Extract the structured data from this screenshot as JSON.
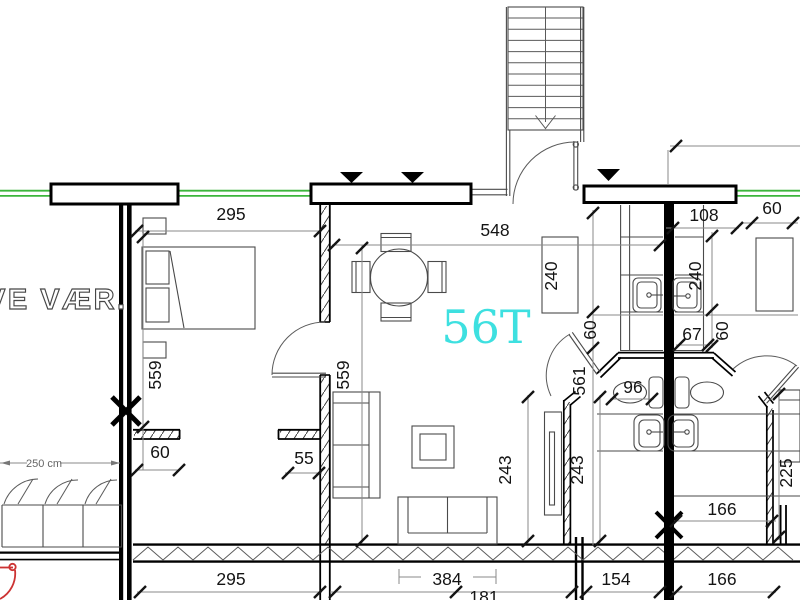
{
  "unit_label": "56T",
  "room_label": "VE VÆR.",
  "closet_width_label": "250 cm",
  "dimensions": {
    "top_295": "295",
    "top_548": "548",
    "top_108": "108",
    "top_right_60": "60",
    "cabinet_240": "240",
    "right_240": "240",
    "right_67": "67",
    "right_60": "60",
    "mid_60": "60",
    "mid_561": "561",
    "wc_96": "96",
    "left_559": "559",
    "left_60": "60",
    "center_559": "559",
    "center_55": "55",
    "left_243": "243",
    "right_243": "243",
    "far_right_225": "225",
    "right_166_upper": "166",
    "right_166_lower": "166",
    "bottom_295": "295",
    "bottom_384": "384",
    "bottom_181": "181",
    "bottom_154": "154"
  },
  "colors": {
    "unit_accent": "#3ee0e0",
    "facade_green": "#3cb53c",
    "door_red": "#cc3333",
    "wall_black": "#000000",
    "dim_gray": "#8a8a8a"
  }
}
